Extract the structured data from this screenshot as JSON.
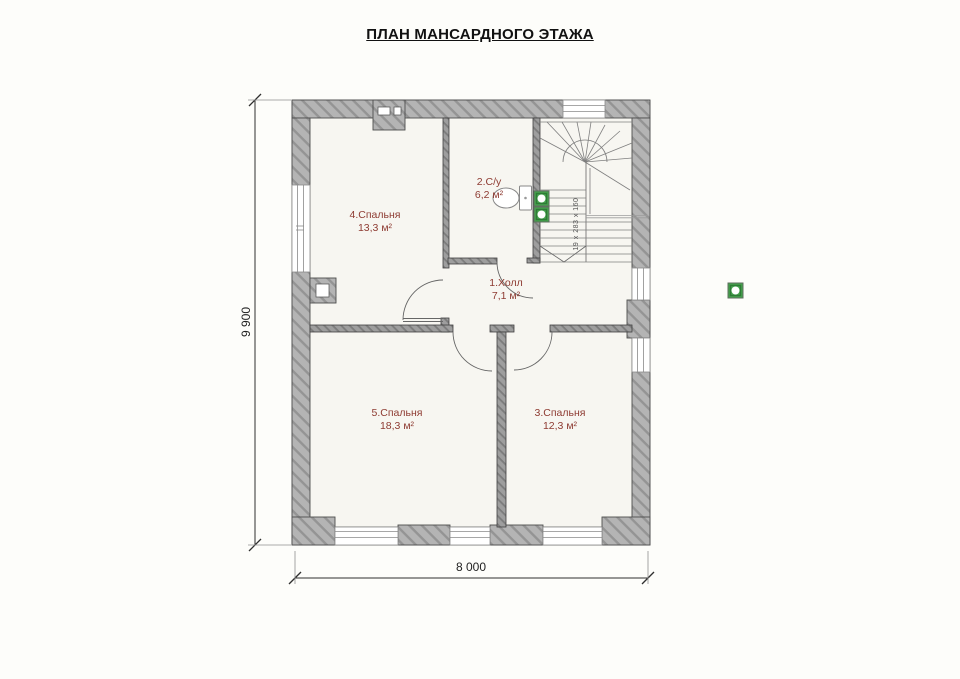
{
  "title": "ПЛАН МАНСАРДНОГО ЭТАЖА",
  "rooms": [
    {
      "name": "4.Спальня",
      "area": "13,3 м²"
    },
    {
      "name": "2.С/у",
      "area": "6,2 м²"
    },
    {
      "name": "1.Холл",
      "area": "7,1 м²"
    },
    {
      "name": "5.Спальня",
      "area": "18,3 м²"
    },
    {
      "name": "3.Спальня",
      "area": "12,3 м²"
    }
  ],
  "stairs": {
    "label": "19 x 283 x 160"
  },
  "dimensions": {
    "width": "8 000",
    "height": "9 900"
  },
  "colors": {
    "room_label": "#8e3b32",
    "wall_gray": "#b4b4b4",
    "interior_wall_gray": "#9e9e9e",
    "vent_green": "#44a24c",
    "floor": "#f7f6f1"
  }
}
